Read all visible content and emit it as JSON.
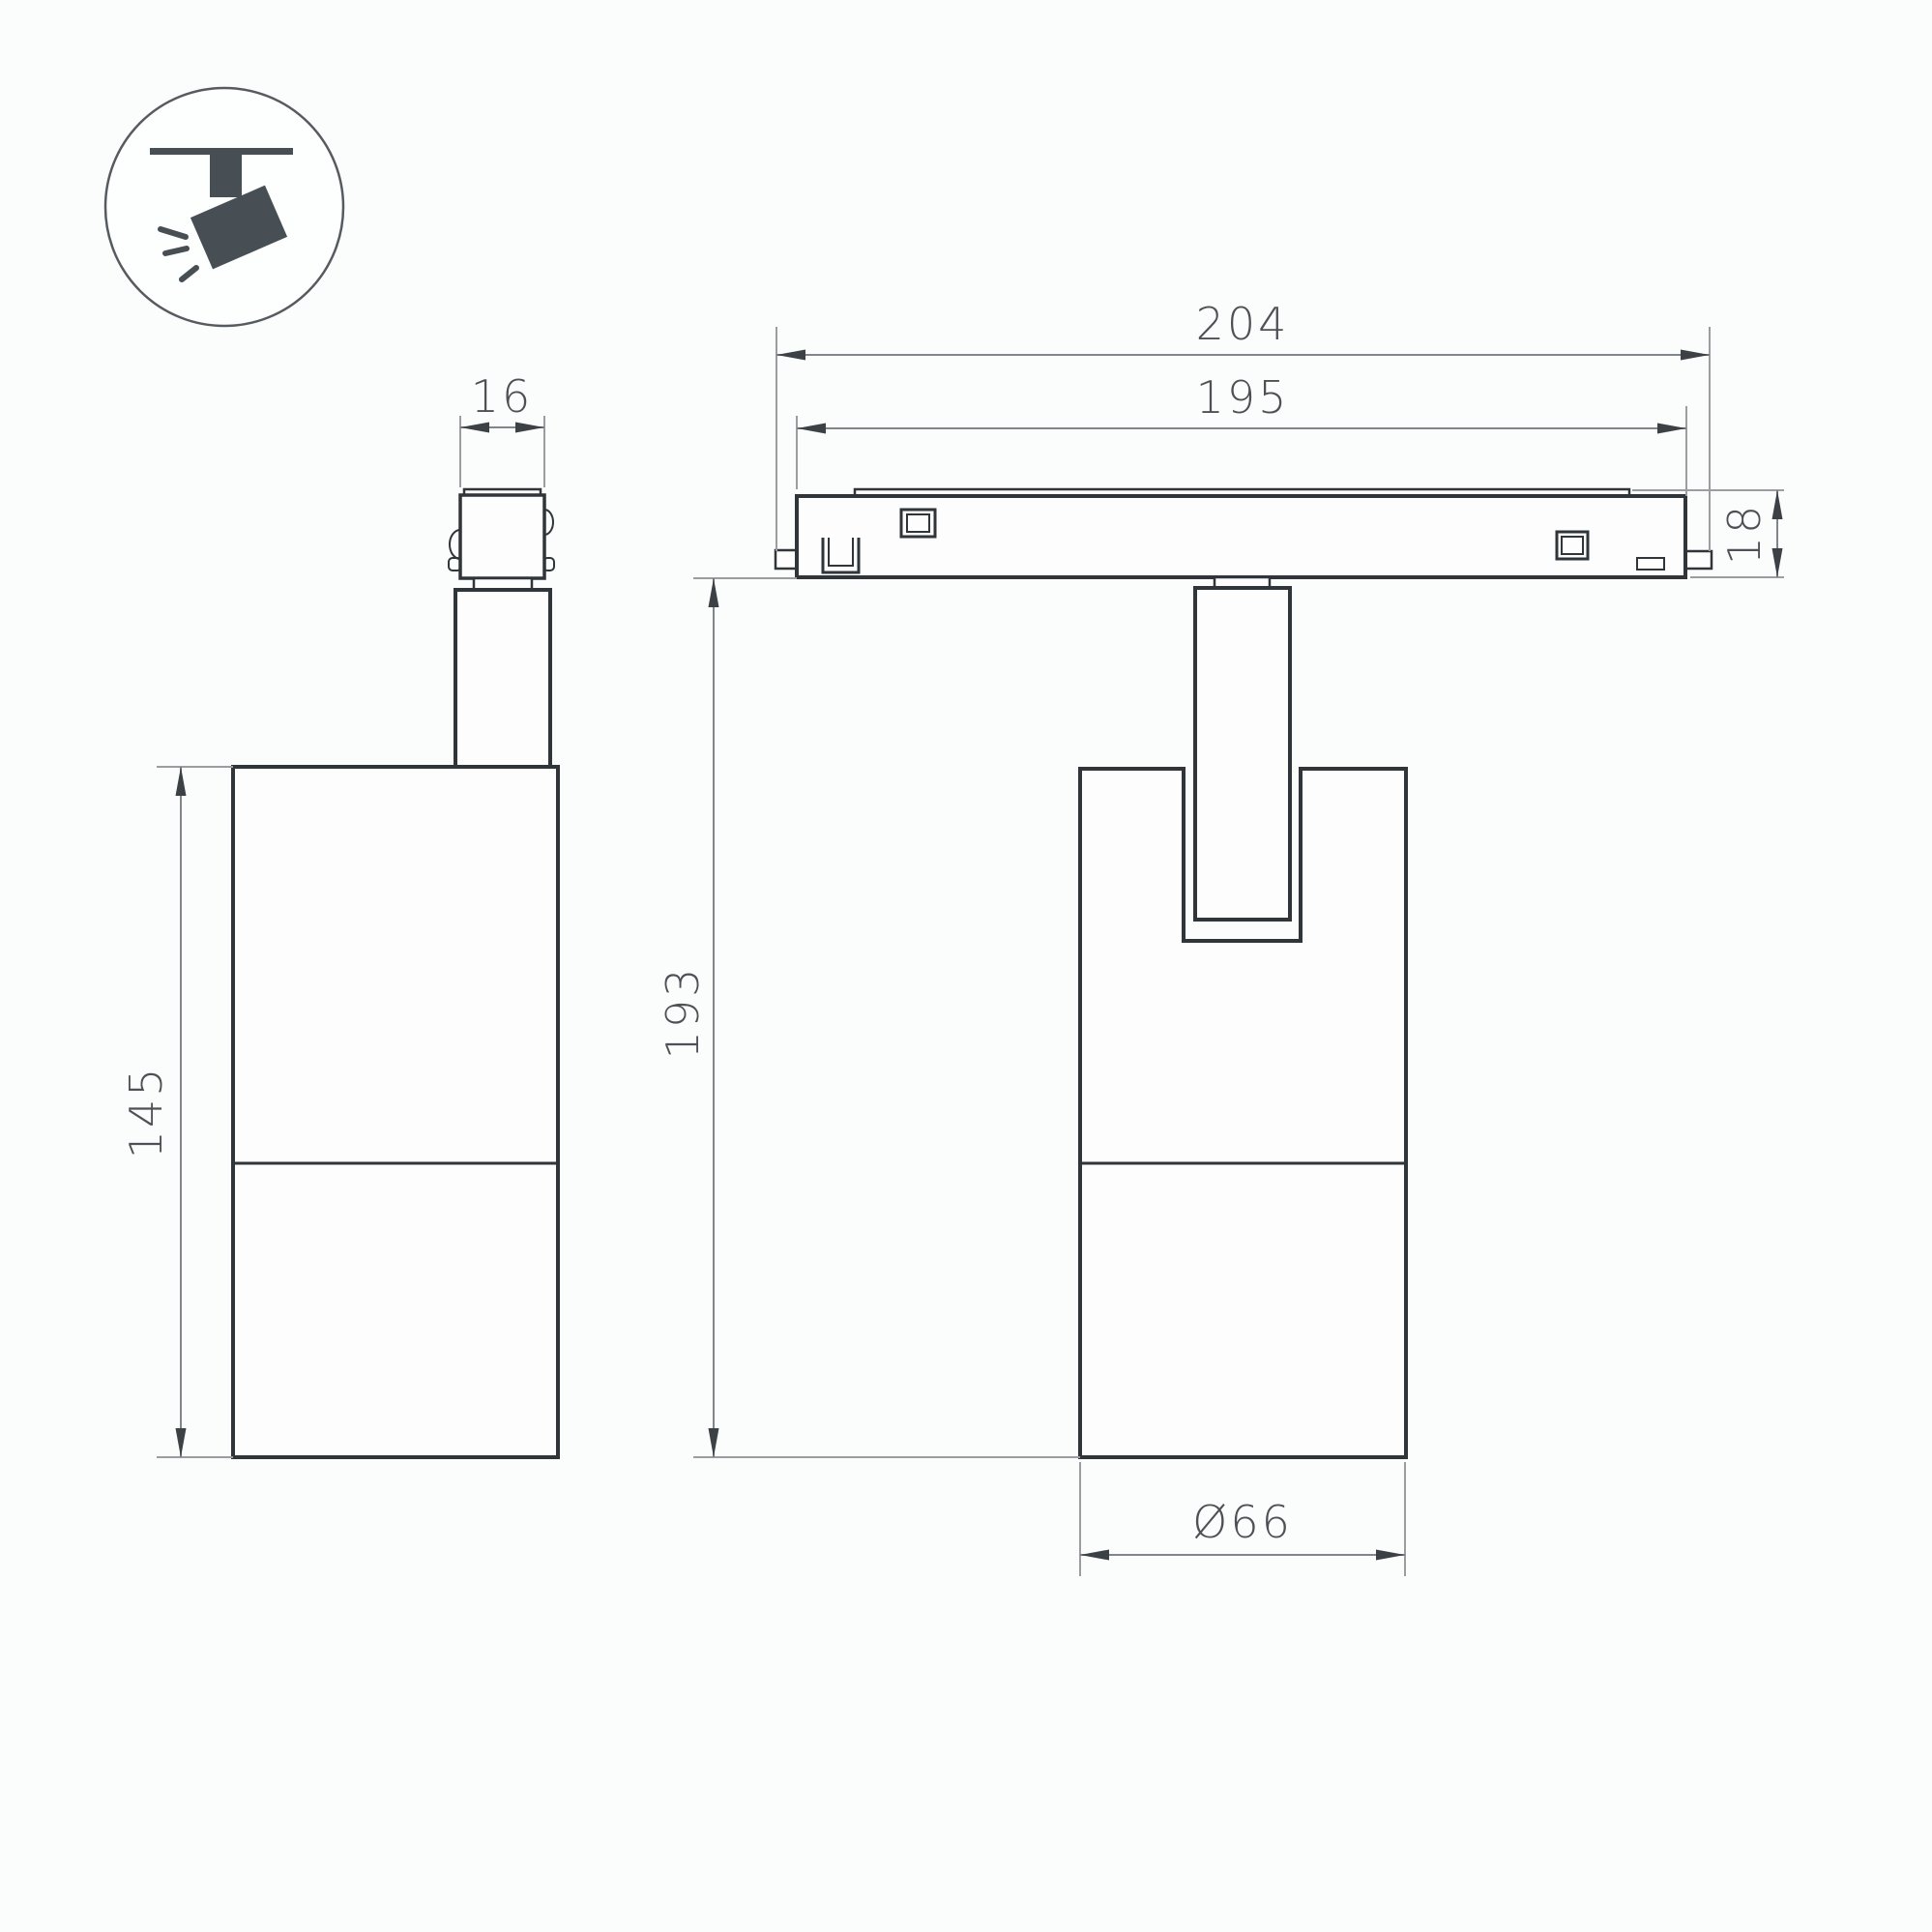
{
  "title": "Track spotlight dimensional drawing",
  "icon": {
    "name": "track-spotlight-icon"
  },
  "colors": {
    "background": "#fbfcfc",
    "outline": "#30353a",
    "dimension_line": "#82868a",
    "arrow": "#3c4145",
    "text": "#4d5155",
    "icon": "#474e54"
  },
  "dimensions": {
    "track_outer_width": "204",
    "track_body_width": "195",
    "track_height": "18",
    "adapter_width": "16",
    "body_height": "145",
    "total_height": "193",
    "body_diameter": "Ø66"
  }
}
